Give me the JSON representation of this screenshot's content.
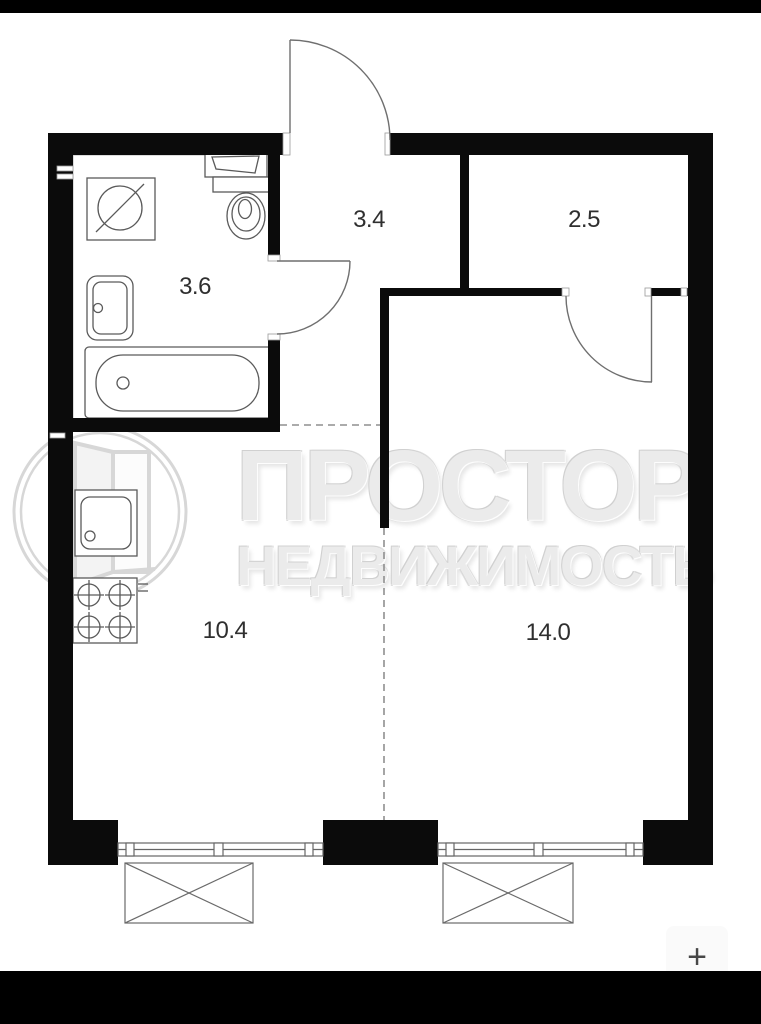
{
  "viewer": {
    "background": "#ffffff",
    "letterbox_color": "#000000",
    "zoom_in_label": "+"
  },
  "watermark": {
    "line1": "ПРОСТОР",
    "line2": "НЕДВИЖИМОСТЬ",
    "text_color": "#ebebeb",
    "logo_icon": "open-door-in-circle-logo"
  },
  "plan": {
    "wall_color": "#0b0b0b",
    "fixture_line_color": "#5a5a5a",
    "dashed_line_color": "#8f8f8f",
    "label_color": "#2f2f2f",
    "rooms": [
      {
        "id": "bathroom",
        "area_label": "3.6"
      },
      {
        "id": "hallway",
        "area_label": "3.4"
      },
      {
        "id": "closet",
        "area_label": "2.5"
      },
      {
        "id": "kitchen-zone",
        "area_label": "10.4"
      },
      {
        "id": "living-zone",
        "area_label": "14.0"
      }
    ],
    "fixture_icons": [
      "washing-machine-icon",
      "wall-sink-icon",
      "toilet-icon",
      "wash-basin-icon",
      "bathtub-icon",
      "kitchen-sink-icon",
      "stove-4-burner-icon",
      "window-icon",
      "window-icon",
      "balcony-box-icon",
      "balcony-box-icon"
    ]
  }
}
